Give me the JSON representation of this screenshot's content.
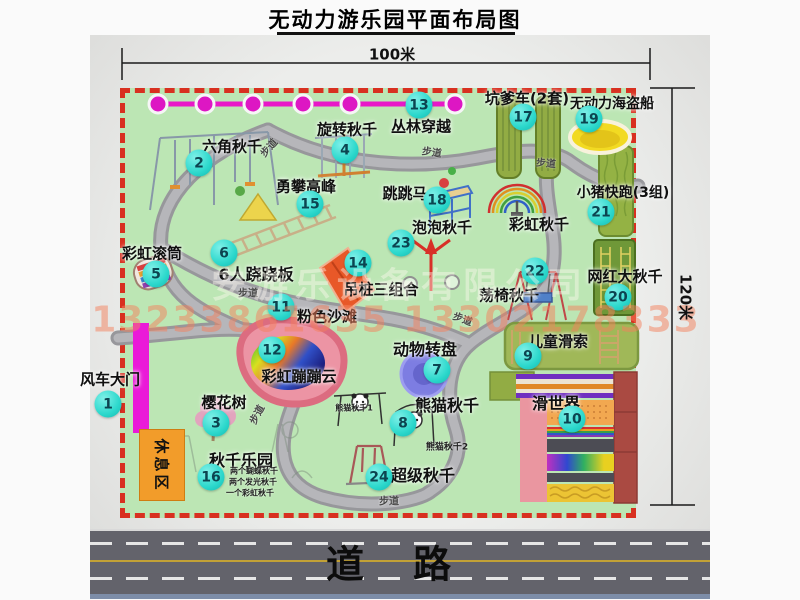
{
  "header": {
    "title": "无动力游乐园平面布局图",
    "top_dim": "100米",
    "right_dim": "120米"
  },
  "road": {
    "char1": "道",
    "char2": "路"
  },
  "watermark": {
    "company": "安游乐设备有限公司",
    "phones": "13233861635 13302178333"
  },
  "map": {
    "rest_area_label": "休息区",
    "walkway_label": "步道",
    "items": [
      {
        "num": "1",
        "label": "风车大门",
        "cx": 108,
        "cy": 404,
        "lx": 110,
        "ly": 379,
        "fs": 15
      },
      {
        "num": "2",
        "label": "六角秋千",
        "cx": 199,
        "cy": 163,
        "lx": 232,
        "ly": 146,
        "fs": 15
      },
      {
        "num": "3",
        "label": "樱花树",
        "cx": 216,
        "cy": 423,
        "lx": 224,
        "ly": 402,
        "fs": 15
      },
      {
        "num": "4",
        "label": "旋转秋千",
        "cx": 345,
        "cy": 150,
        "lx": 347,
        "ly": 129,
        "fs": 15
      },
      {
        "num": "5",
        "label": "彩虹滚筒",
        "cx": 156,
        "cy": 274,
        "lx": 152,
        "ly": 253,
        "fs": 15
      },
      {
        "num": "6",
        "label": "6人跷跷板",
        "cx": 224,
        "cy": 253,
        "lx": 256,
        "ly": 273,
        "fs": 16
      },
      {
        "num": "7",
        "label": "动物转盘",
        "cx": 437,
        "cy": 370,
        "lx": 425,
        "ly": 348,
        "fs": 16
      },
      {
        "num": "8",
        "label": "熊猫秋千",
        "cx": 403,
        "cy": 423,
        "lx": 447,
        "ly": 404,
        "fs": 16
      },
      {
        "num": "9",
        "label": "儿童滑索",
        "cx": 528,
        "cy": 356,
        "lx": 558,
        "ly": 341,
        "fs": 15
      },
      {
        "num": "10",
        "label": "滑世界",
        "cx": 572,
        "cy": 419,
        "lx": 556,
        "ly": 402,
        "fs": 16
      },
      {
        "num": "11",
        "label": "粉色沙滩",
        "cx": 281,
        "cy": 307,
        "lx": 327,
        "ly": 316,
        "fs": 15
      },
      {
        "num": "12",
        "label": "彩虹蹦蹦云",
        "cx": 272,
        "cy": 350,
        "lx": 299,
        "ly": 376,
        "fs": 15
      },
      {
        "num": "13",
        "label": "丛林穿越",
        "cx": 419,
        "cy": 105,
        "lx": 421,
        "ly": 126,
        "fs": 15
      },
      {
        "num": "14",
        "label": "吊桩三组合",
        "cx": 358,
        "cy": 263,
        "lx": 381,
        "ly": 289,
        "fs": 15
      },
      {
        "num": "15",
        "label": "勇攀高峰",
        "cx": 310,
        "cy": 204,
        "lx": 306,
        "ly": 186,
        "fs": 15
      },
      {
        "num": "16",
        "label": "秋千乐园",
        "cx": 211,
        "cy": 477,
        "lx": 241,
        "ly": 459,
        "fs": 16
      },
      {
        "num": "17",
        "label": "坑爹车(2套)",
        "cx": 523,
        "cy": 117,
        "lx": 527,
        "ly": 98,
        "fs": 15
      },
      {
        "num": "18",
        "label": "跳跳马",
        "cx": 437,
        "cy": 200,
        "lx": 405,
        "ly": 193,
        "fs": 15
      },
      {
        "num": "19",
        "label": "无动力海盗船",
        "cx": 589,
        "cy": 119,
        "lx": 612,
        "ly": 103,
        "fs": 14
      },
      {
        "num": "20",
        "label": "网红大秋千",
        "cx": 618,
        "cy": 297,
        "lx": 625,
        "ly": 276,
        "fs": 15
      },
      {
        "num": "21",
        "label": "小猪快跑(3组)",
        "cx": 601,
        "cy": 212,
        "lx": 623,
        "ly": 192,
        "fs": 14
      },
      {
        "num": "22",
        "label": "荡椅秋千",
        "cx": 535,
        "cy": 271,
        "lx": 509,
        "ly": 295,
        "fs": 15
      },
      {
        "num": "23",
        "label": "泡泡秋千",
        "cx": 401,
        "cy": 243,
        "lx": 442,
        "ly": 227,
        "fs": 15
      },
      {
        "num": "24",
        "label": "超级秋千",
        "cx": 379,
        "cy": 477,
        "lx": 423,
        "ly": 474,
        "fs": 16
      }
    ],
    "extra_labels": [
      {
        "text": "彩虹秋千",
        "x": 539,
        "y": 224,
        "fs": 15,
        "bold": true
      },
      {
        "text": "熊猫秋千1",
        "x": 354,
        "y": 408,
        "fs": 8,
        "bold": false
      },
      {
        "text": "熊猫秋千2",
        "x": 447,
        "y": 446,
        "fs": 9,
        "bold": false
      },
      {
        "text": "两个蝴蝶秋千",
        "x": 254,
        "y": 471,
        "fs": 8,
        "bold": false
      },
      {
        "text": "两个发光秋千",
        "x": 253,
        "y": 482,
        "fs": 8,
        "bold": false
      },
      {
        "text": "一个彩虹秋千",
        "x": 250,
        "y": 493,
        "fs": 8,
        "bold": false
      }
    ],
    "walkway_positions": [
      {
        "x": 268,
        "y": 147,
        "rot": -48
      },
      {
        "x": 432,
        "y": 151,
        "rot": 8
      },
      {
        "x": 546,
        "y": 162,
        "rot": 5
      },
      {
        "x": 248,
        "y": 292,
        "rot": 0
      },
      {
        "x": 463,
        "y": 318,
        "rot": 20
      },
      {
        "x": 256,
        "y": 414,
        "rot": -62
      },
      {
        "x": 389,
        "y": 500,
        "rot": 0
      }
    ]
  },
  "colors": {
    "map_green": "#bce6b4",
    "border_red": "#d83020",
    "marker_cyan": "#2cd8cc",
    "gate_magenta": "#ea1ad8",
    "chain_magenta": "#e818c8",
    "road_gray": "#63636b",
    "rest_orange": "#f29c2a"
  }
}
